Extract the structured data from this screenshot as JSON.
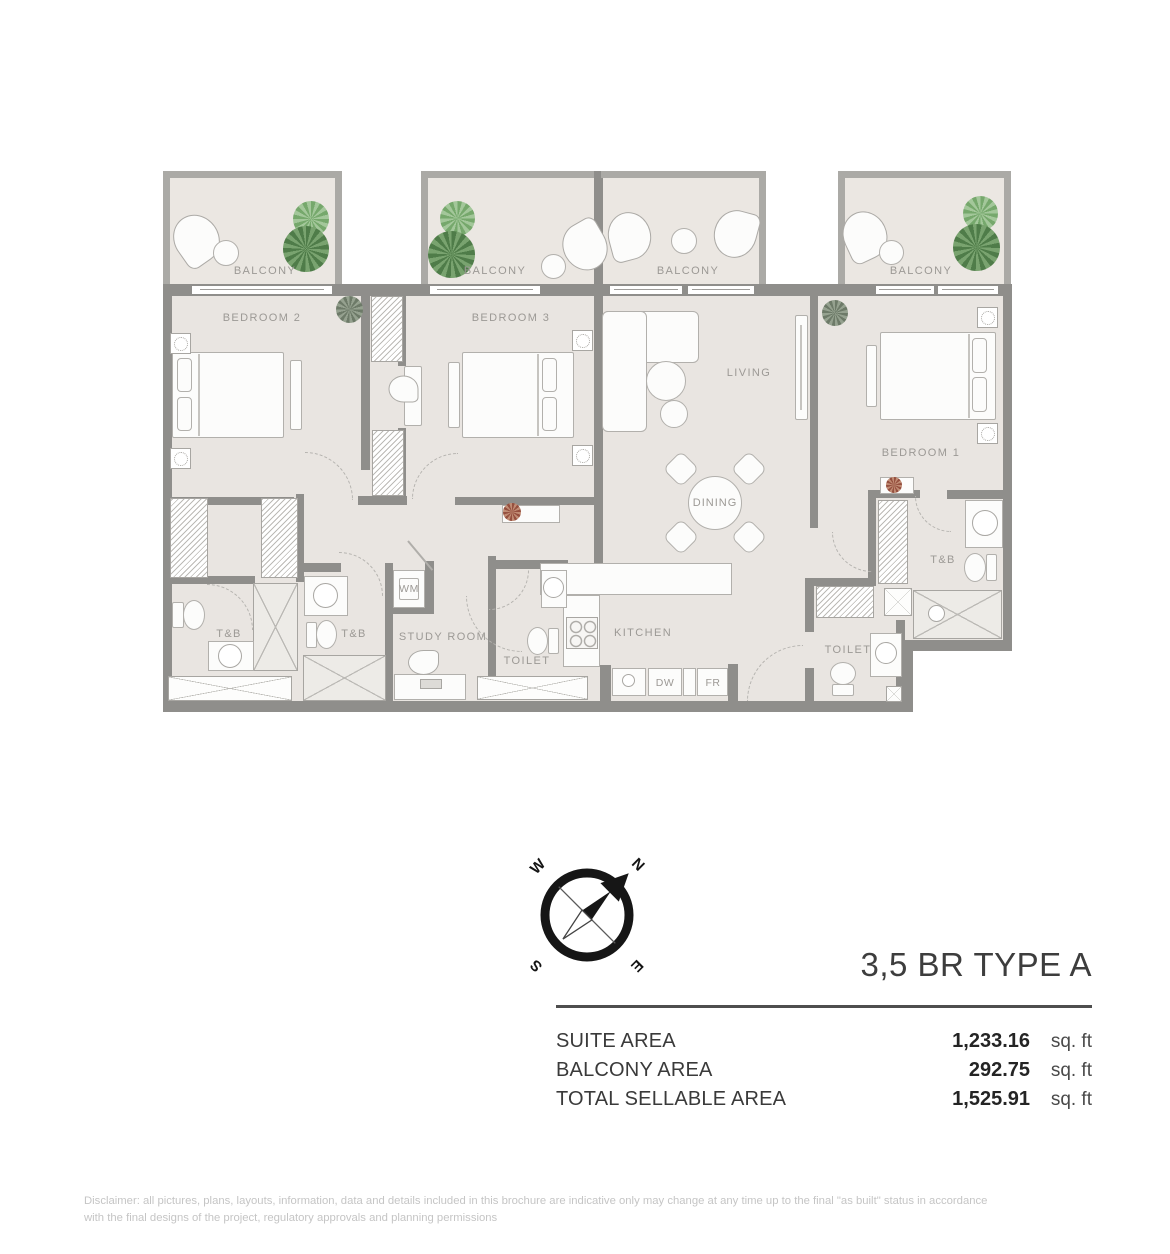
{
  "meta": {
    "title": "3,5 BR TYPE A",
    "disclaimer_line1": "Disclaimer: all pictures, plans, layouts, information, data and details included in this brochure are indicative only may change at any time up to the final \"as built\" status in accordance",
    "disclaimer_line2": "with the final designs of the project, regulatory approvals and planning permissions"
  },
  "plan": {
    "rooms": {
      "balcony": "BALCONY",
      "bedroom1": "BEDROOM 1",
      "bedroom2": "BEDROOM 2",
      "bedroom3": "BEDROOM 3",
      "living": "LIVING",
      "dining": "DINING",
      "kitchen": "KITCHEN",
      "study_room": "STUDY ROOM",
      "toilet": "TOILET",
      "tb": "T&B",
      "wm": "WM",
      "dw": "DW",
      "fr": "FR"
    }
  },
  "compass": {
    "n": "N",
    "e": "E",
    "s": "S",
    "w": "W"
  },
  "areas": {
    "rows": [
      {
        "label": "SUITE AREA",
        "value": "1,233.16",
        "unit": "sq. ft"
      },
      {
        "label": "BALCONY AREA",
        "value": "292.75",
        "unit": "sq. ft"
      },
      {
        "label": "TOTAL SELLABLE AREA",
        "value": "1,525.91",
        "unit": "sq. ft"
      }
    ]
  },
  "colors": {
    "wall": "#8f8e8b",
    "floor": "#e9e5e1",
    "plant_green": "#5a8352"
  }
}
